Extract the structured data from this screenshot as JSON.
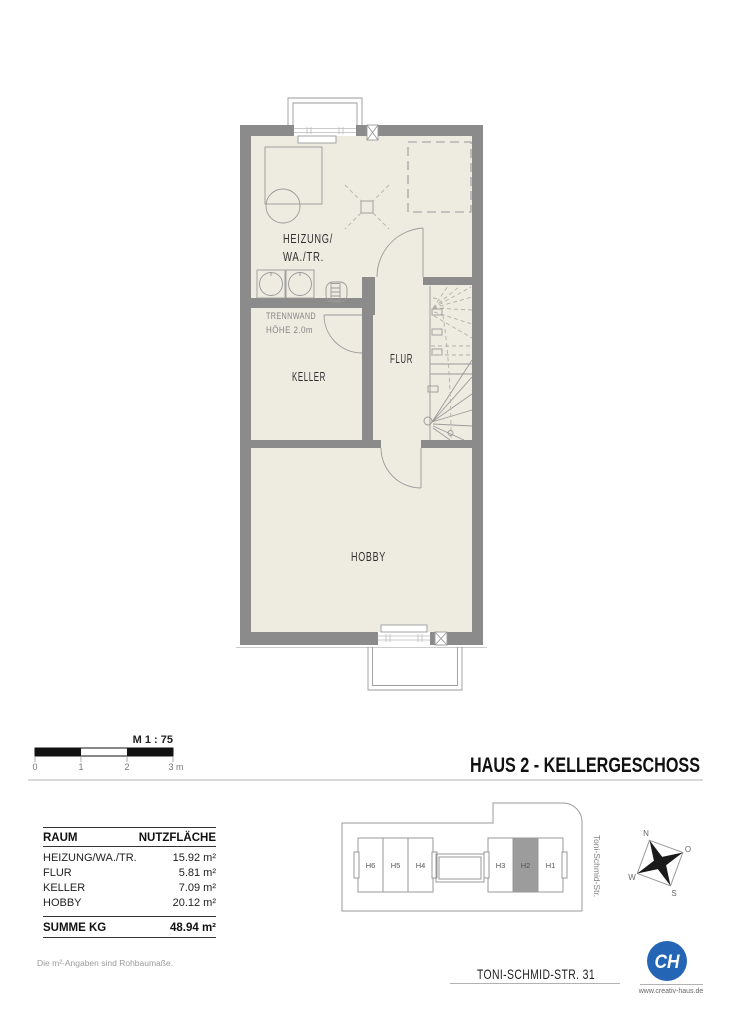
{
  "theme": {
    "wall": "#8b8b8b",
    "floor": "#eeebe1",
    "line": "#9a9a9a",
    "highlight": "#9c9c9c",
    "logo_blue": "#2565b5"
  },
  "title": {
    "text": "HAUS 2 - KELLERGESCHOSS"
  },
  "scalebar": {
    "label": "M 1 : 75",
    "ticks": [
      "0",
      "1",
      "2",
      "3 m"
    ]
  },
  "plan": {
    "labels": {
      "heizung1": "HEIZUNG/",
      "heizung2": "WA./TR.",
      "trennwand1": "TRENNWAND",
      "trennwand2": "HÖHE 2.0m",
      "keller": "KELLER",
      "flur": "FLUR",
      "hobby": "HOBBY"
    }
  },
  "area_table": {
    "col_room": "RAUM",
    "col_area": "NUTZFLÄCHE",
    "rows": [
      {
        "room": "HEIZUNG/WA./TR.",
        "area": "15.92 m²"
      },
      {
        "room": "FLUR",
        "area": "5.81 m²"
      },
      {
        "room": "KELLER",
        "area": "7.09 m²"
      },
      {
        "room": "HOBBY",
        "area": "20.12 m²"
      }
    ],
    "total_room": "SUMME KG",
    "total_area": "48.94 m²"
  },
  "footnote": "Die m²-Angaben sind Rohbaumaße.",
  "siteplan": {
    "units": [
      "H6",
      "H5",
      "H4",
      "H3",
      "H2",
      "H1"
    ],
    "highlighted_unit": "H2",
    "street": "Toni-Schmid-Str."
  },
  "compass": {
    "n": "N",
    "o": "O",
    "s": "S",
    "w": "W"
  },
  "footer": {
    "address": "TONI-SCHMID-STR. 31",
    "website": "www.creativ-haus.de",
    "logo_initials": "CH"
  }
}
